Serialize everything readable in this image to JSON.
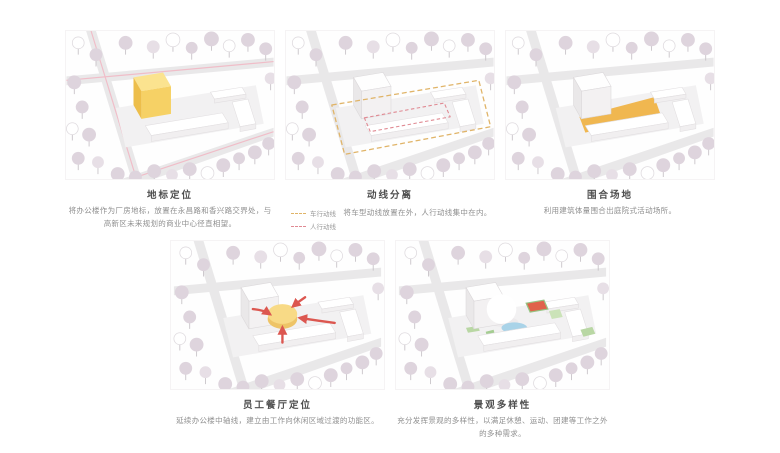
{
  "panels": [
    {
      "title": "地标定位",
      "body": "将办公楼作为厂房地标，放置在永昌路和香兴路交界处，与高新区未来规划的商业中心径直相望。"
    },
    {
      "title": "动线分离",
      "body": "将车型动线放置在外，人行动线集中在内。",
      "legend": [
        {
          "label": "车行动线",
          "color": "#e0b468"
        },
        {
          "label": "人行动线",
          "color": "#e08a93"
        }
      ]
    },
    {
      "title": "围合场地",
      "body": "利用建筑体量围合出庭院式活动场所。"
    },
    {
      "title": "员工餐厅定位",
      "body": "延续办公楼中轴线，建立由工作向休闲区域过渡的功能区。"
    },
    {
      "title": "景观多样性",
      "body": "充分发挥景观的多样性，以满足休憩、运动、团建等工作之外的多种需求。"
    }
  ],
  "colors": {
    "road": "#e9e8e9",
    "road_centerline_pink": "#f0bdc8",
    "site": "#f2f1f2",
    "tree_mauve": "#ded4dd",
    "landmark_yellow": "#f6d165",
    "courtyard_yellow": "#f0b750",
    "vehicle_route": "#e0b468",
    "pedestrian_route": "#e08a93",
    "arrow_red": "#dc5750",
    "pond_blue": "#a9d3e8",
    "court_red": "#e0634b",
    "landscape_green": "#b9d7a4"
  }
}
